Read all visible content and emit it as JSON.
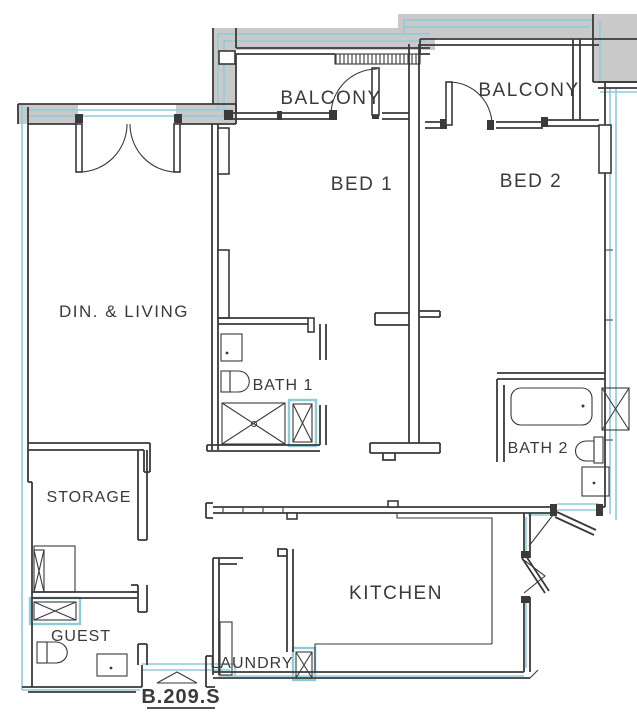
{
  "plan": {
    "unit_label": "B.209.S",
    "rooms": {
      "balcony_1": "BALCONY",
      "balcony_2": "BALCONY",
      "bed_1": "BED 1",
      "bed_2": "BED 2",
      "dining_living": "DIN. & LIVING",
      "bath_1": "BATH 1",
      "bath_2": "BATH 2",
      "storage": "STORAGE",
      "guest": "GUEST",
      "kitchen": "KITCHEN",
      "laundry": "LAUNDRY"
    },
    "colors": {
      "background": "#ffffff",
      "line": "#3a3a3a",
      "wall_fill": "#c9c9c9",
      "accent": "#8eccda"
    }
  }
}
